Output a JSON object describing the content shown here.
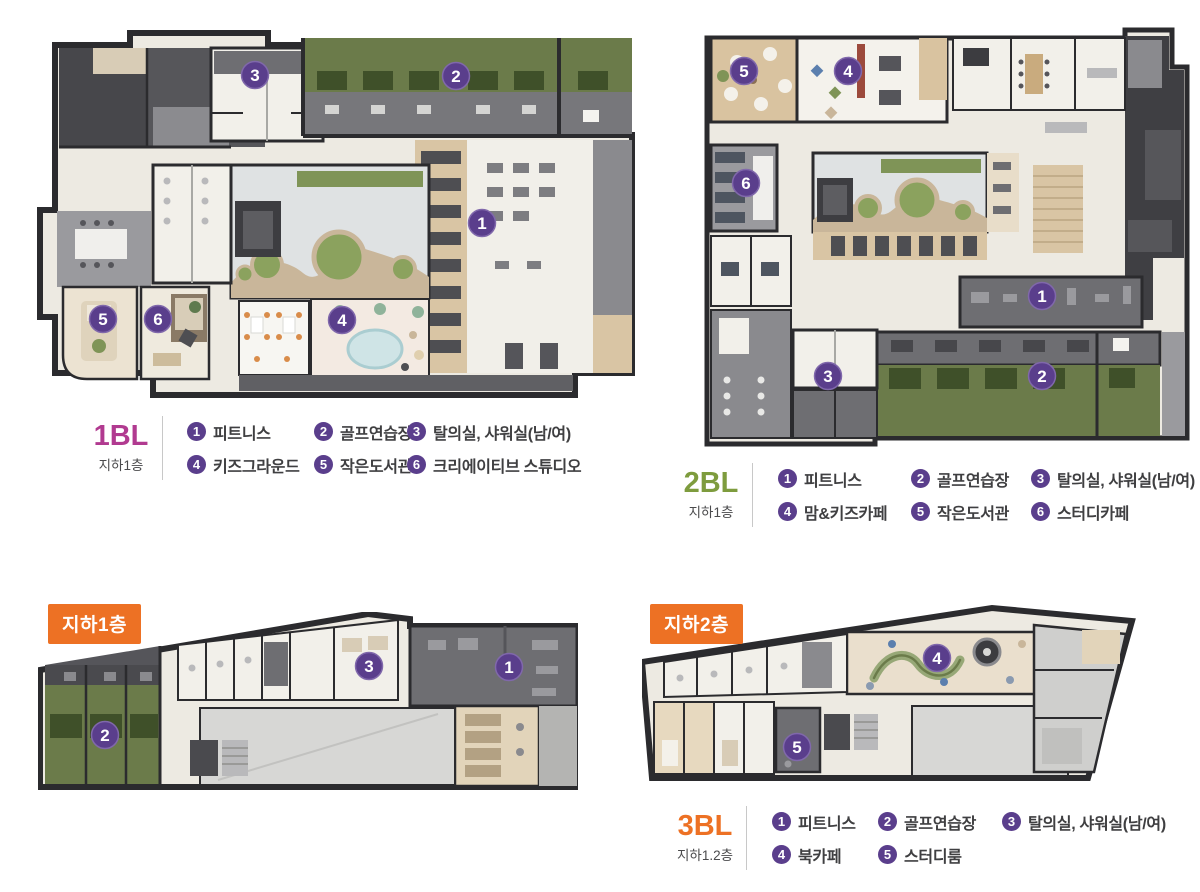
{
  "palette": {
    "marker_purple": "#5a3e8c",
    "badge_orange": "#ed7124",
    "title_1bl": "#b13a90",
    "title_2bl": "#7e9c3e",
    "title_3bl": "#ed7124",
    "legend_text": "#3f3f41",
    "turf_green": "#6b7b4a",
    "wall_dark": "#2b2b2e"
  },
  "blocks": {
    "bl1": {
      "title": "1BL",
      "subtitle": "지하1층",
      "legend": [
        {
          "num": "1",
          "label": "피트니스"
        },
        {
          "num": "2",
          "label": "골프연습장"
        },
        {
          "num": "3",
          "label": "탈의실, 샤워실(남/여)"
        },
        {
          "num": "4",
          "label": "키즈그라운드"
        },
        {
          "num": "5",
          "label": "작은도서관"
        },
        {
          "num": "6",
          "label": "크리에이티브 스튜디오"
        }
      ]
    },
    "bl2": {
      "title": "2BL",
      "subtitle": "지하1층",
      "legend": [
        {
          "num": "1",
          "label": "피트니스"
        },
        {
          "num": "2",
          "label": "골프연습장"
        },
        {
          "num": "3",
          "label": "탈의실, 샤워실(남/여)"
        },
        {
          "num": "4",
          "label": "맘&키즈카페"
        },
        {
          "num": "5",
          "label": "작은도서관"
        },
        {
          "num": "6",
          "label": "스터디카페"
        }
      ]
    },
    "bl3": {
      "title": "3BL",
      "subtitle": "지하1.2층",
      "floor_badge_b1": "지하1층",
      "floor_badge_b2": "지하2층",
      "legend": [
        {
          "num": "1",
          "label": "피트니스"
        },
        {
          "num": "2",
          "label": "골프연습장"
        },
        {
          "num": "3",
          "label": "탈의실, 샤워실(남/여)"
        },
        {
          "num": "4",
          "label": "북카페"
        },
        {
          "num": "5",
          "label": "스터디룸"
        }
      ]
    }
  },
  "plan_markers": {
    "bl1": [
      "1",
      "2",
      "3",
      "4",
      "5",
      "6"
    ],
    "bl2": [
      "1",
      "2",
      "3",
      "4",
      "5",
      "6"
    ],
    "b1f": [
      "1",
      "2",
      "3"
    ],
    "b2f": [
      "4",
      "5"
    ]
  }
}
